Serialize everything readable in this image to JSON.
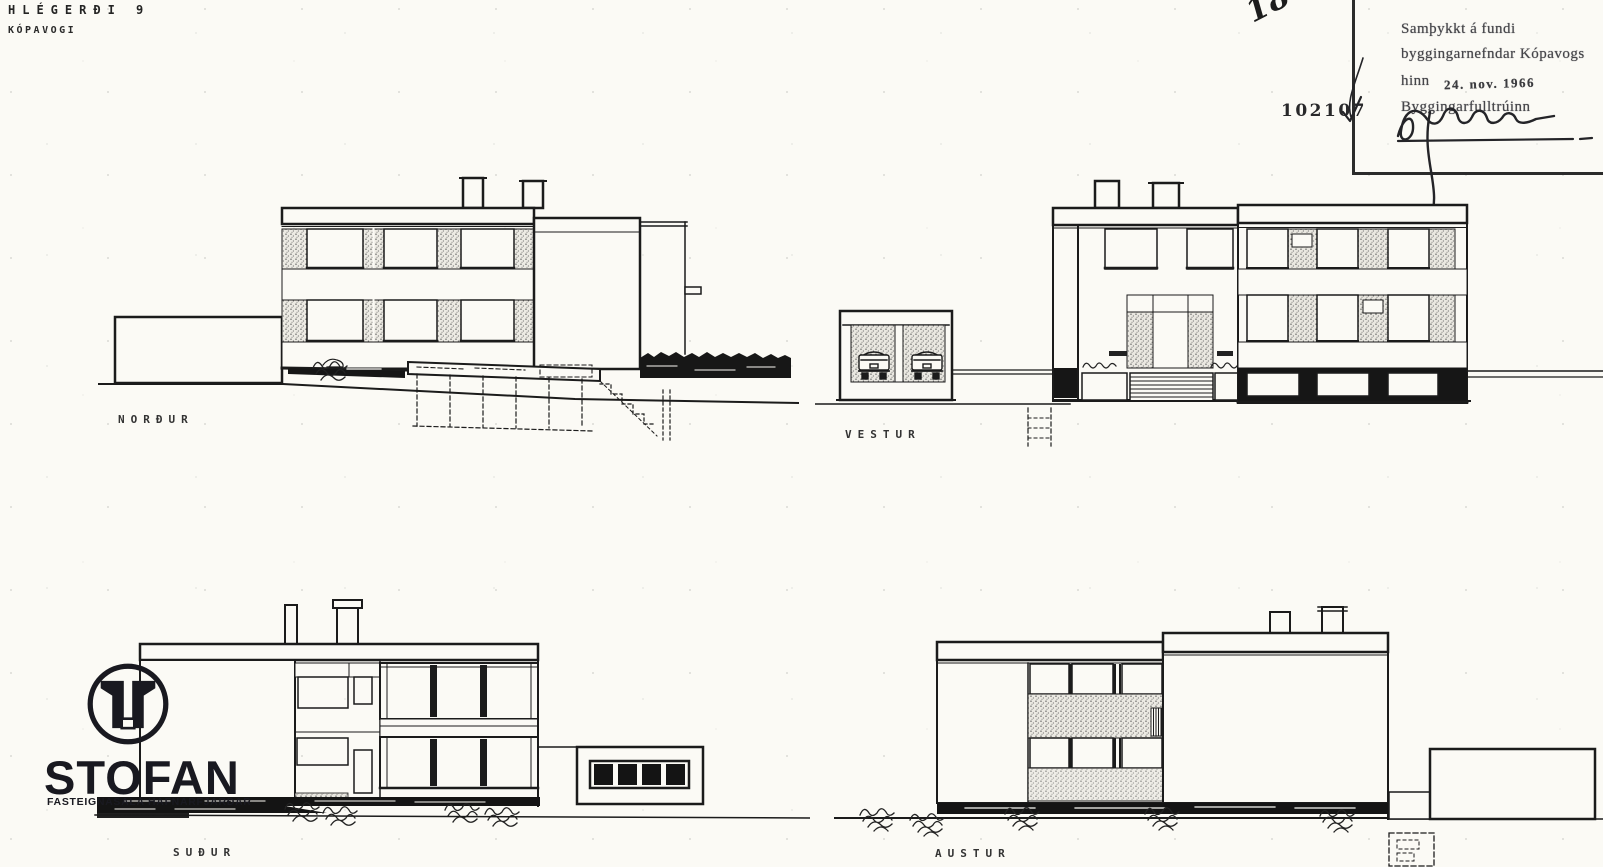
{
  "page": {
    "title": {
      "line1": "HLÉGERÐI 9",
      "line2": "KÓPAVOGI"
    },
    "annotations": {
      "handwritten_number": "186/66",
      "file_number": "102107"
    },
    "approval_stamp": {
      "line1": "Samþykkt á fundi",
      "line2": "byggingarnefndar Kópavogs",
      "line3_prefix": "hinn",
      "date": "24. nov. 1966",
      "line4": "Byggingarfulltrúinn"
    },
    "elevations": [
      {
        "id": "north",
        "label": "NORÐUR"
      },
      {
        "id": "west",
        "label": "VESTUR"
      },
      {
        "id": "south",
        "label": "SUÐUR"
      },
      {
        "id": "east",
        "label": "AUSTUR"
      }
    ],
    "watermark": {
      "brand": "STOFAN",
      "subtitle": "FASTEIGNASALA HAFNARFJARÐAR"
    },
    "colors": {
      "paper": "#fbfaf5",
      "ink": "#1b1b1b",
      "logo_ink": "#191920",
      "stamp_ink": "#46464a"
    }
  }
}
